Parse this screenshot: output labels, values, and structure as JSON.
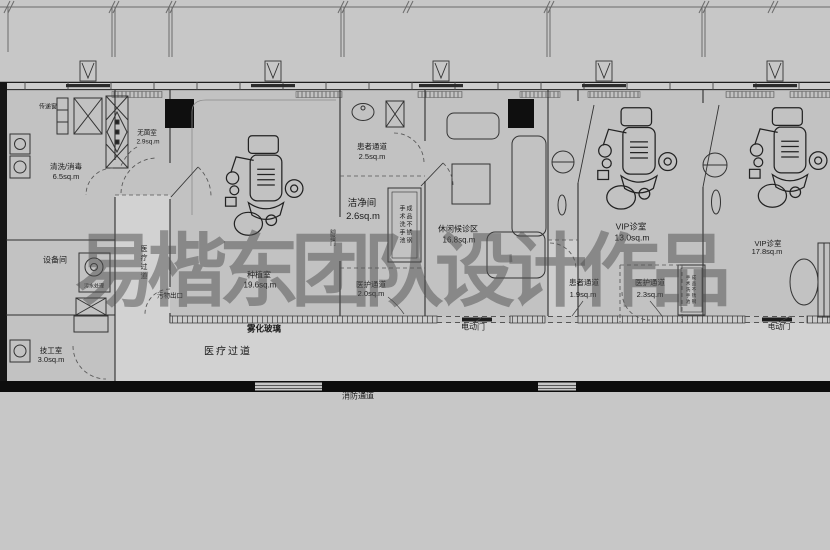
{
  "watermark": "易楷东团队设计作品",
  "rooms": {
    "clean_disinfect": {
      "name": "清洗/消毒",
      "area": "6.5sq.m"
    },
    "sterile": {
      "name": "无菌室",
      "area": "2.9sq.m"
    },
    "equipment": {
      "name": "设备间"
    },
    "technician": {
      "name": "技工室",
      "area": "3.0sq.m"
    },
    "implant": {
      "name": "种植室",
      "area": "19.6sq.m"
    },
    "patient_corridor_a": {
      "name": "患者通道",
      "area": "2.5sq.m"
    },
    "clean_room": {
      "name": "洁净间",
      "area": "2.6sq.m"
    },
    "staff_corridor_a": {
      "name": "医护通道",
      "area": "2.0sq.m"
    },
    "waiting": {
      "name": "休闲候诊区",
      "area": "16.8sq.m"
    },
    "vip_a": {
      "name": "VIP诊室",
      "area": "13.0sq.m"
    },
    "patient_corridor_b": {
      "name": "患者通道",
      "area": "1.9sq.m"
    },
    "staff_corridor_b": {
      "name": "医护通道",
      "area": "2.3sq.m"
    },
    "vip_b": {
      "name": "VIP诊室",
      "area": "17.8sq.m"
    }
  },
  "annotations": {
    "pass_window": "传递窗",
    "sewage_treatment": "污水处理",
    "waste_exit": "污物出口",
    "medical_corridor_vertical": "医疗过道",
    "medical_corridor": "医疗过道",
    "fog_glass": "雾化玻璃",
    "fire_corridor": "消防通道",
    "electric_door": "电动门",
    "foot_pedal_door": "脚踏门",
    "wash_station": "成品不锈钢手术洗手池"
  }
}
